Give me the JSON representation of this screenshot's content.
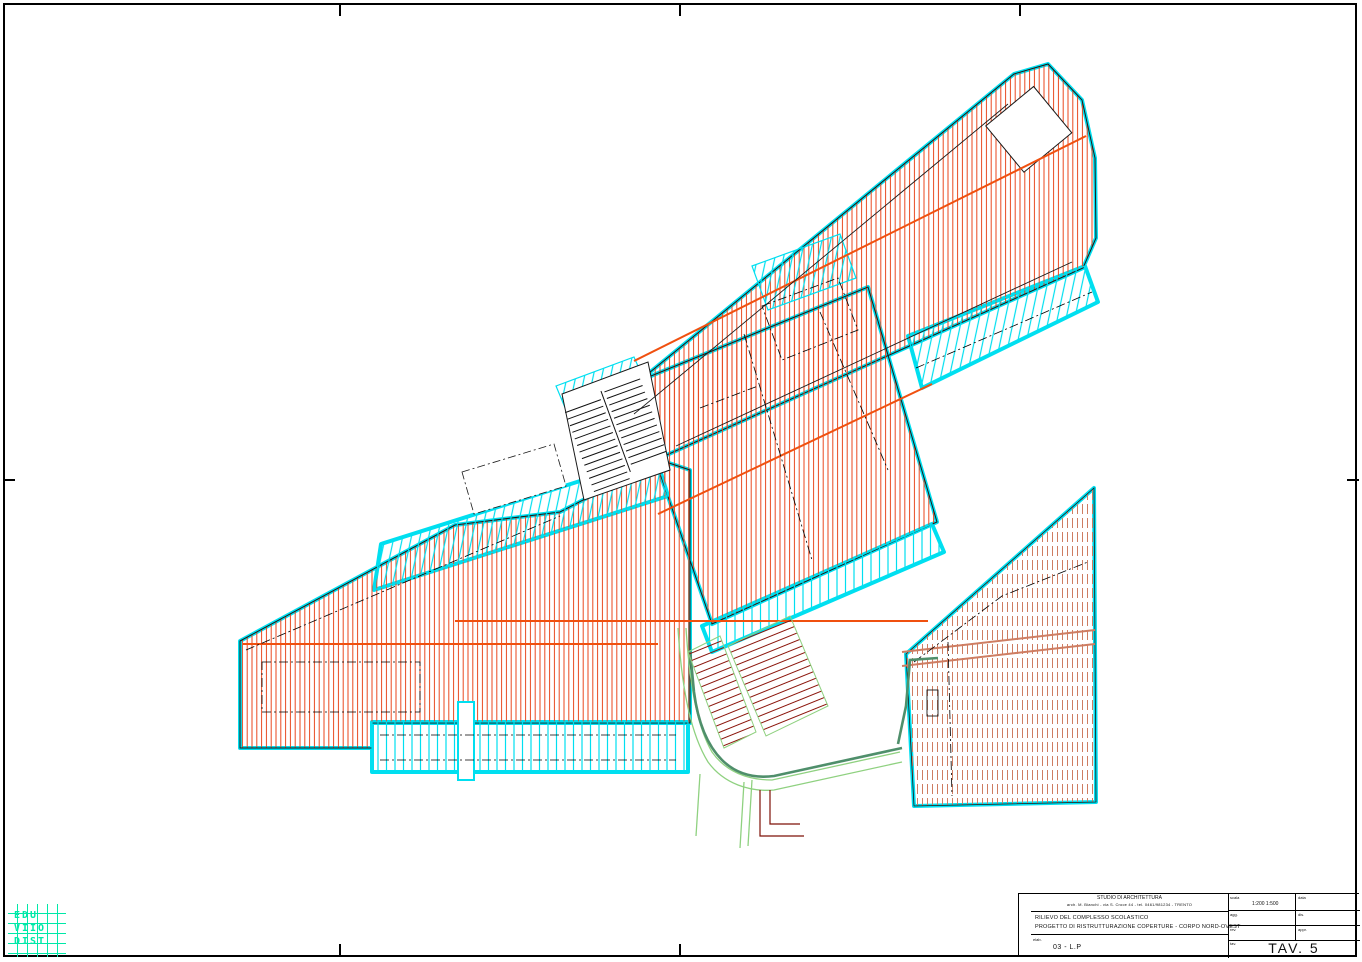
{
  "page": {
    "sheet_label": "TAV. 5"
  },
  "colors": {
    "roof_hatch_red": "#E8471E",
    "ridge_orange": "#F0500F",
    "roof_hatch_salmon": "#CE7D62",
    "outline_cyan": "#00DFF0",
    "logo_green": "#00E8A8",
    "path_light_green": "#8FD180",
    "path_dark_green": "#4F8F6B",
    "stair_dark_red": "#8B150B",
    "line_black": "#1A1A1A"
  },
  "logo": {
    "rows": [
      "EDU",
      "VIIO",
      "DIST"
    ]
  },
  "titleblock": {
    "header_line1": "STUDIO DI ARCHITETTURA",
    "header_line2": "arch. M. Bianchi - via S. Croce 44 - tel. 0461/981234 - TRENTO",
    "title_line1": "RILIEVO DEL COMPLESSO SCOLASTICO",
    "title_line2": "PROGETTO DI RISTRUTTURAZIONE COPERTURE - CORPO NORD-OVEST",
    "object_label": "elab.",
    "object_value": "03 - L.P",
    "fields": {
      "scala_label": "scala",
      "scala_value": "1:200  1:500",
      "data_label": "data",
      "agg_label": "agg.",
      "dis_label": "dis.",
      "rev_label": "rev.",
      "appr_label": "appr.",
      "tav_label": "tav.",
      "sheet": "TAV. 5"
    }
  }
}
